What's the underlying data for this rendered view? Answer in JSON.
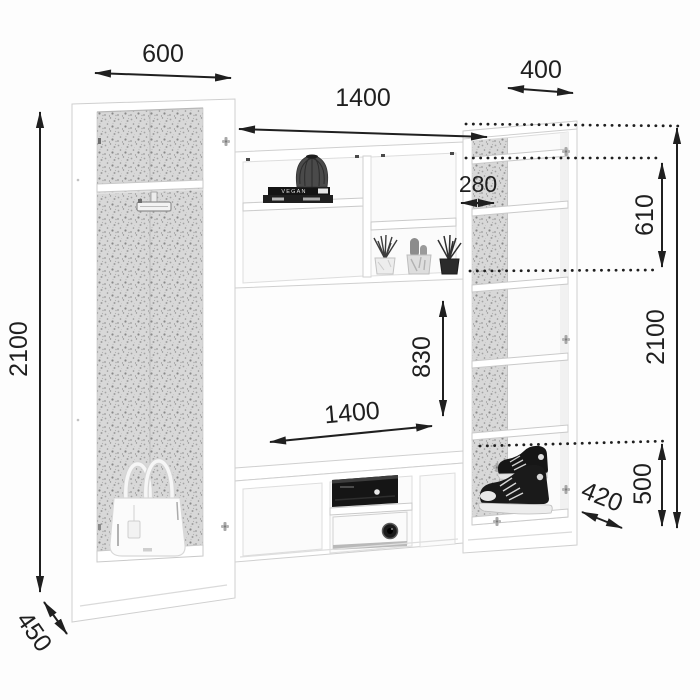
{
  "diagram": {
    "title": "Wall unit furniture dimensional drawing",
    "units": "mm",
    "colors": {
      "line": "#1f1f1f",
      "panel": "#ffffff",
      "panel_edge": "#cfcfcf",
      "backer_speckle_base": "#d8d8d8",
      "background": "#fdfdfd"
    },
    "labels": {
      "left_width": "600",
      "right_width": "400",
      "niche_width_top": "1400",
      "top_shelf_depth": "280",
      "right_top_section_height": "610",
      "right_total_height": "2100",
      "left_total_height": "2100",
      "niche_height": "830",
      "niche_width_bottom": "1400",
      "right_bottom_section_height": "500",
      "right_depth": "420",
      "left_depth": "450"
    },
    "decor": {
      "book_spine_text": "VEGAN",
      "items": [
        "ribbed-vase",
        "books",
        "grass-plant",
        "cacti-pot",
        "dark-plant",
        "white-handbag",
        "black-media-player",
        "white-projector",
        "black-sneakers",
        "clothes-rail-bracket"
      ]
    }
  }
}
